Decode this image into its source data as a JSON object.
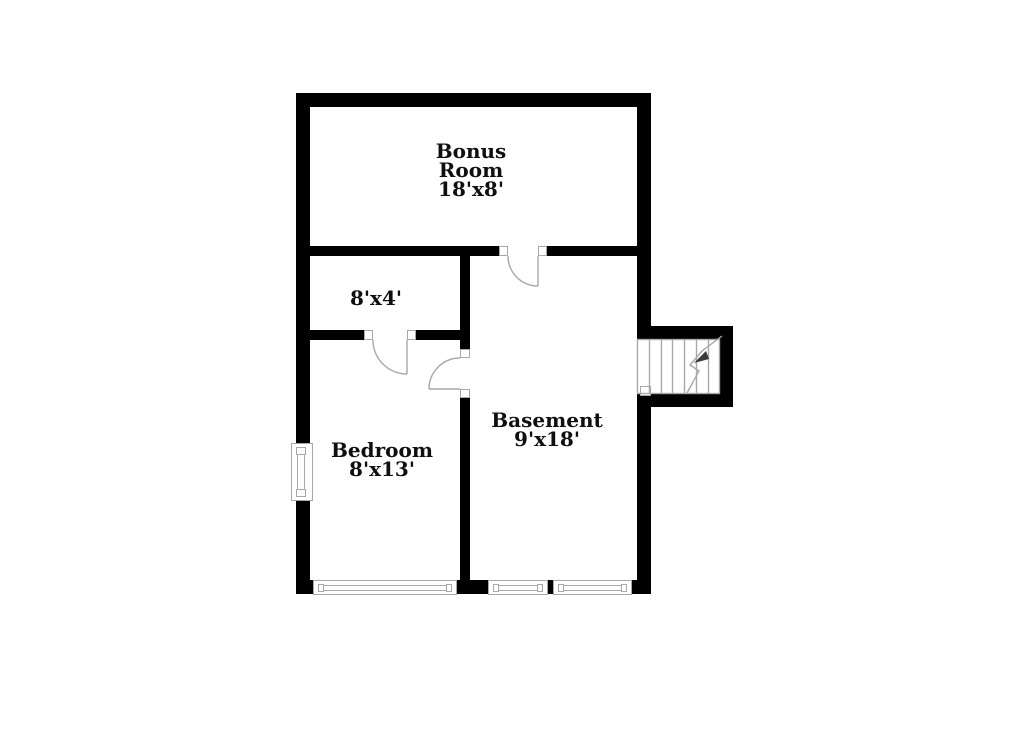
{
  "colors": {
    "wall": "#000000",
    "symbol_line": "#a8a8a8",
    "text": "#0f0f0f",
    "background": "#ffffff"
  },
  "rooms": {
    "bonus": {
      "name": "Bonus Room",
      "dims": "18'x8'"
    },
    "hall": {
      "dims": "8'x4'"
    },
    "bedroom": {
      "name": "Bedroom",
      "dims": "8'x13'"
    },
    "basement": {
      "name": "Basement",
      "dims": "9'x18'"
    }
  },
  "symbols": {
    "doors": 3,
    "windows": 4,
    "staircase": 1
  }
}
